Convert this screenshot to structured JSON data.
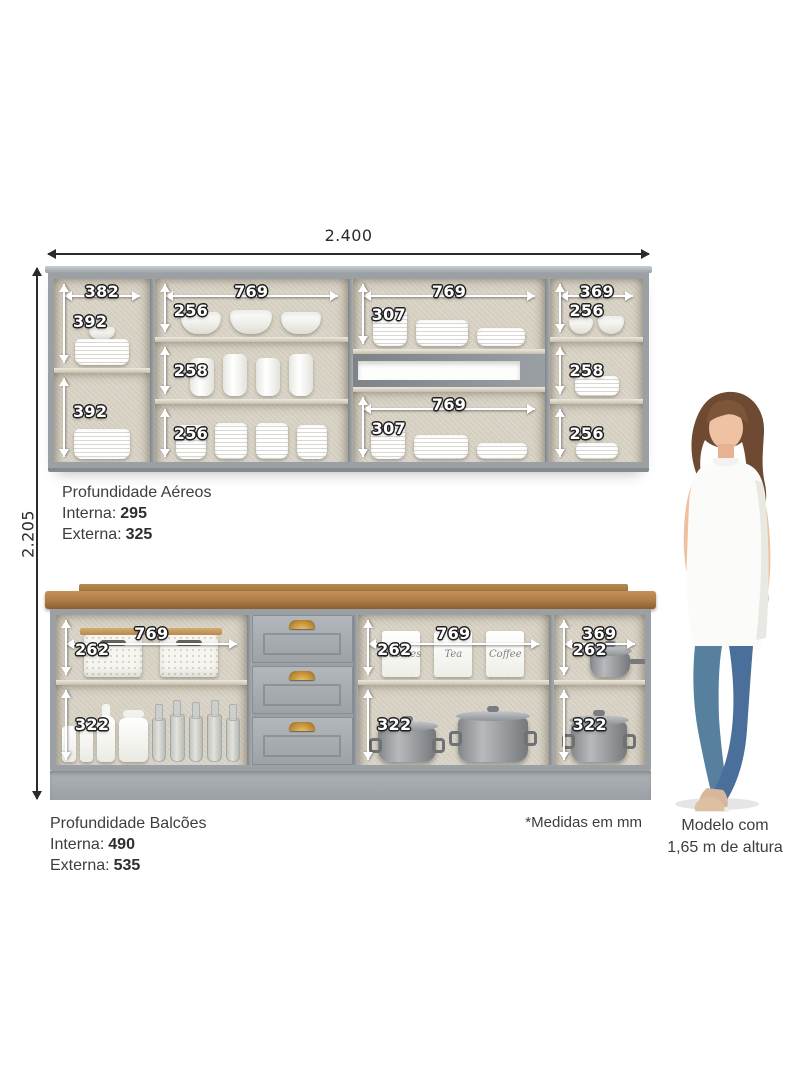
{
  "colors": {
    "cabinet_gray": "#9ba0a5",
    "interior_beige": "#d7d1c3",
    "countertop_wood": "#ad7c44",
    "handle_gold": "#c28f35",
    "dimension_text": "#ffffff",
    "dimension_outline": "#1e1e1e",
    "body_text": "#3d3d3d"
  },
  "overall": {
    "width": "2.400",
    "height": "2.205"
  },
  "upper": {
    "col1": {
      "w": "382",
      "h1": "392",
      "h2": "392"
    },
    "col2": {
      "w": "769",
      "h1": "256",
      "h2": "258",
      "h3": "256"
    },
    "col3": {
      "w_top": "769",
      "h_top": "307",
      "w_bot": "769",
      "h_bot": "307"
    },
    "col4": {
      "w": "369",
      "h1": "256",
      "h2": "258",
      "h3": "256"
    }
  },
  "upper_note": {
    "title": "Profundidade Aéreos",
    "l1": "Interna:",
    "v1": "295",
    "l2": "Externa:",
    "v2": "325"
  },
  "lower": {
    "sec1": {
      "w": "769",
      "h1": "262",
      "h2": "322"
    },
    "sec3": {
      "w": "769",
      "h1": "262",
      "h2": "322"
    },
    "sec4": {
      "w": "369",
      "h1": "262",
      "h2": "322"
    },
    "canisters": [
      "Cookies",
      "Tea",
      "Coffee"
    ]
  },
  "lower_note": {
    "title": "Profundidade Balcões",
    "l1": "Interna:",
    "v1": "490",
    "l2": "Externa:",
    "v2": "535"
  },
  "footnote": "*Medidas em mm",
  "model": {
    "line1": "Modelo com",
    "line2": "1,65 m de altura"
  }
}
